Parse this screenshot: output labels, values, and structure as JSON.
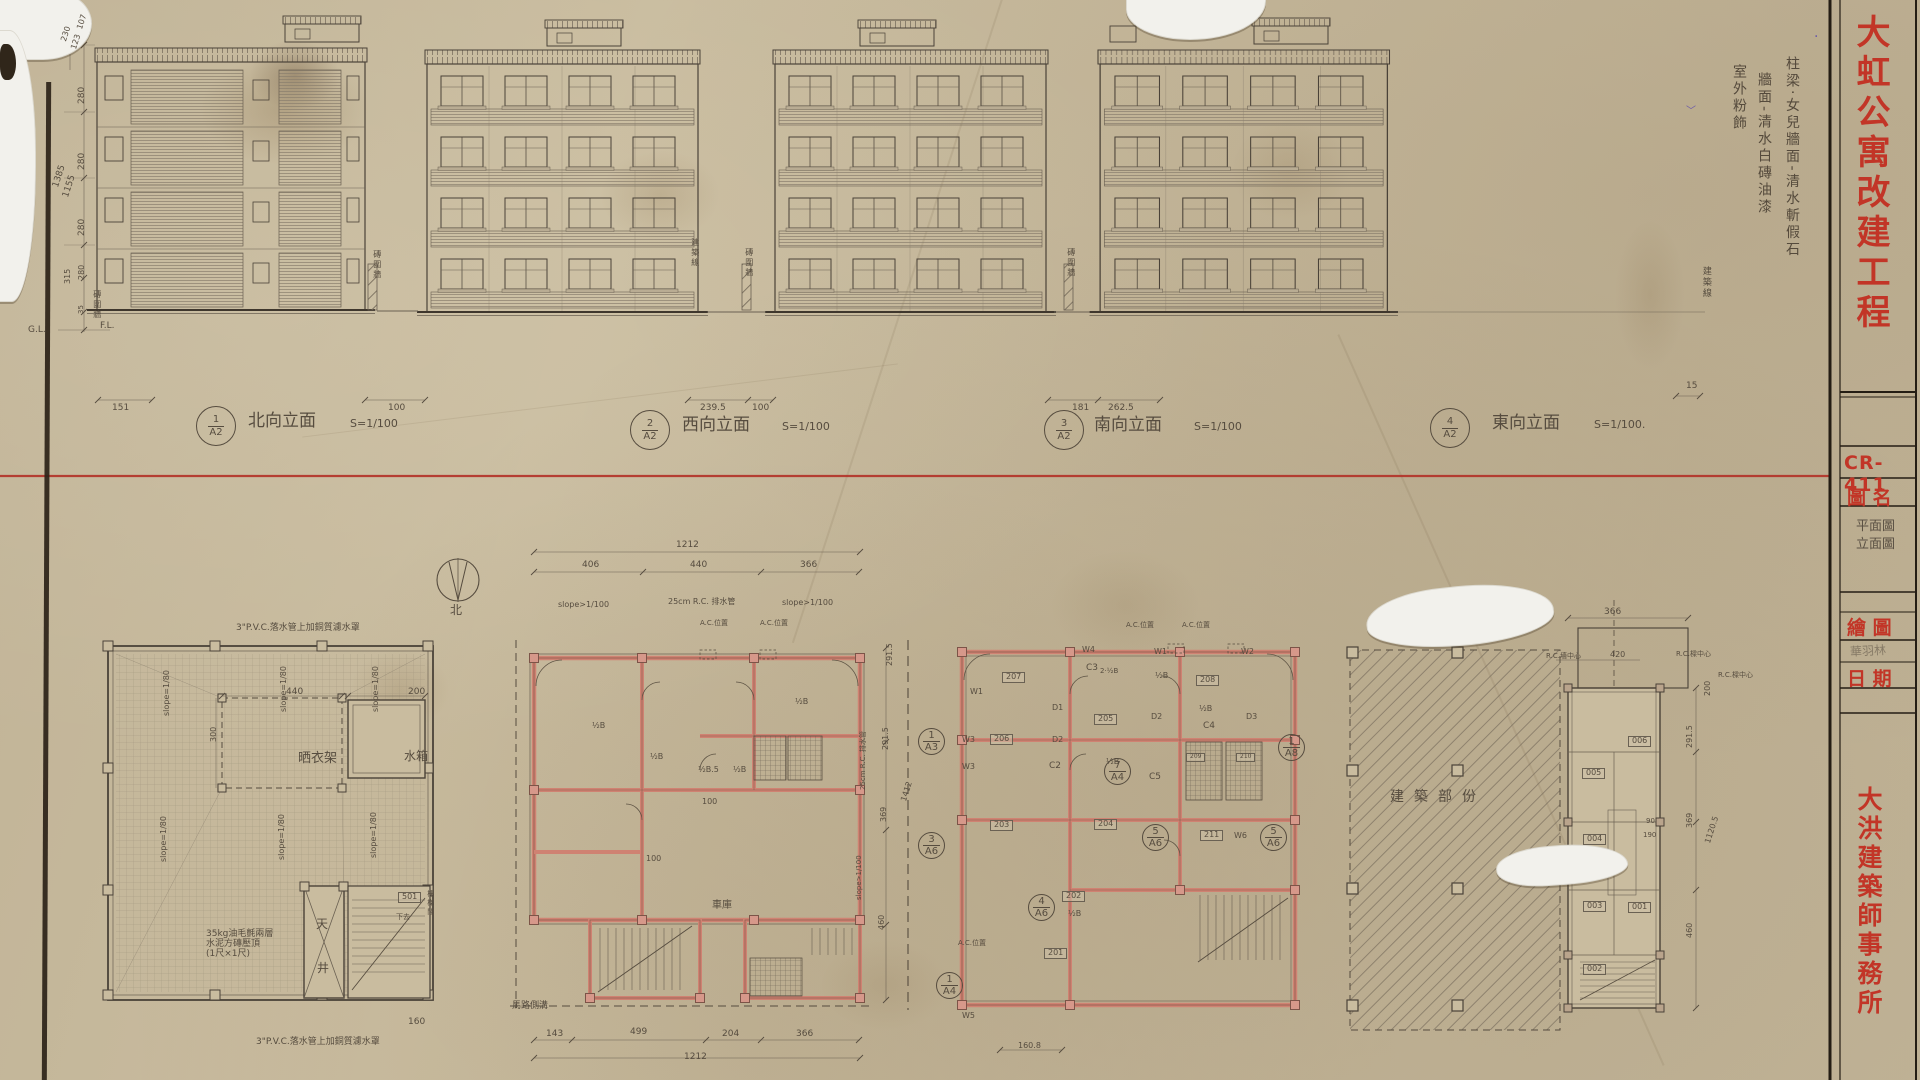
{
  "palette": {
    "pencil": "#564c3f",
    "dark": "#4a4238",
    "red": "#bf342a",
    "pink": "#cf8272",
    "paper": "#c9bc9f",
    "purple": "#6a5aa8"
  },
  "title_block": {
    "project_title": "大虹公寓改建工程",
    "drawing_no": "CR-411",
    "drawing_name_label": "圖 名",
    "drawing_name_line1": "平面圖",
    "drawing_name_line2": "立面圖",
    "drawn_by_label": "繪 圖",
    "drawn_by": "華羽林",
    "date_label": "日 期",
    "firm": "大洪建築師事務所"
  },
  "finish_notes": [
    "柱梁·女兒牆面-清水斬假石",
    "牆面-清水白磚油漆",
    "室外粉飾"
  ],
  "elevation_labels": [
    {
      "num": "1",
      "sheet": "A2",
      "name": "北向立面",
      "scale": "S=1/100"
    },
    {
      "num": "2",
      "sheet": "A2",
      "name": "西向立面",
      "scale": "S=1/100"
    },
    {
      "num": "3",
      "sheet": "A2",
      "name": "南向立面",
      "scale": "S=1/100"
    },
    {
      "num": "4",
      "sheet": "A2",
      "name": "東向立面",
      "scale": "S=1/100."
    }
  ],
  "annotations": [
    {
      "t": "107",
      "x": 76,
      "y": 28,
      "r": -72,
      "s": 8
    },
    {
      "t": "123",
      "x": 70,
      "y": 48,
      "r": -72,
      "s": 8
    },
    {
      "t": "230",
      "x": 60,
      "y": 40,
      "r": -72,
      "s": 8
    },
    {
      "t": "280",
      "x": 78,
      "y": 104,
      "r": -90,
      "s": 9
    },
    {
      "t": "280",
      "x": 78,
      "y": 170,
      "r": -90,
      "s": 9
    },
    {
      "t": "280",
      "x": 78,
      "y": 236,
      "r": -90,
      "s": 9
    },
    {
      "t": "1385",
      "x": 52,
      "y": 186,
      "r": -72,
      "s": 9
    },
    {
      "t": "1155",
      "x": 62,
      "y": 196,
      "r": -72,
      "s": 9
    },
    {
      "t": "315",
      "x": 64,
      "y": 284,
      "r": -90,
      "s": 8
    },
    {
      "t": "280",
      "x": 78,
      "y": 280,
      "r": -90,
      "s": 8
    },
    {
      "t": "35",
      "x": 78,
      "y": 314,
      "r": -90,
      "s": 7
    },
    {
      "t": "G.L.",
      "x": 28,
      "y": 326,
      "s": 9
    },
    {
      "t": "F.L.",
      "x": 100,
      "y": 322,
      "s": 9
    },
    {
      "t": "磚圍牆",
      "x": 92,
      "y": 290,
      "s": 8,
      "cls": "vert"
    },
    {
      "t": "151",
      "x": 112,
      "y": 404,
      "s": 9
    },
    {
      "t": "100",
      "x": 388,
      "y": 404,
      "s": 9
    },
    {
      "t": "239.5",
      "x": 700,
      "y": 404,
      "s": 9
    },
    {
      "t": "100",
      "x": 752,
      "y": 404,
      "s": 9
    },
    {
      "t": "181",
      "x": 1072,
      "y": 404,
      "s": 9
    },
    {
      "t": "262.5",
      "x": 1108,
      "y": 404,
      "s": 9
    },
    {
      "t": "15",
      "x": 1686,
      "y": 382,
      "s": 9
    },
    {
      "t": "磚圍牆",
      "x": 372,
      "y": 250,
      "s": 8,
      "cls": "vert"
    },
    {
      "t": "磚圍牆",
      "x": 744,
      "y": 248,
      "s": 8,
      "cls": "vert"
    },
    {
      "t": "磚圍牆",
      "x": 1066,
      "y": 248,
      "s": 8,
      "cls": "vert"
    },
    {
      "t": "建築線",
      "x": 690,
      "y": 238,
      "s": 8,
      "cls": "vert"
    },
    {
      "t": "建築線",
      "x": 1700,
      "y": 266,
      "s": 9,
      "cls": "vert"
    },
    {
      "t": "1|A2",
      "x": 196,
      "y": 406,
      "cls": "frac"
    },
    {
      "t": "北向立面",
      "x": 248,
      "y": 412,
      "s": 17
    },
    {
      "t": "S=1/100",
      "x": 350,
      "y": 418,
      "s": 11
    },
    {
      "t": "2|A2",
      "x": 630,
      "y": 410,
      "cls": "frac"
    },
    {
      "t": "西向立面",
      "x": 682,
      "y": 416,
      "s": 17
    },
    {
      "t": "S=1/100",
      "x": 782,
      "y": 421,
      "s": 11
    },
    {
      "t": "3|A2",
      "x": 1044,
      "y": 410,
      "cls": "frac"
    },
    {
      "t": "南向立面",
      "x": 1094,
      "y": 416,
      "s": 17
    },
    {
      "t": "S=1/100",
      "x": 1194,
      "y": 421,
      "s": 11
    },
    {
      "t": "4|A2",
      "x": 1430,
      "y": 408,
      "cls": "frac"
    },
    {
      "t": "東向立面",
      "x": 1492,
      "y": 414,
      "s": 17
    },
    {
      "t": "S=1/100.",
      "x": 1594,
      "y": 419,
      "s": 11
    },
    {
      "t": "北",
      "x": 450,
      "y": 604,
      "s": 12
    },
    {
      "t": "3\"P.V.C.落水管上加銅質濾水罩",
      "x": 236,
      "y": 624,
      "s": 9
    },
    {
      "t": "3\"P.V.C.落水管上加銅質濾水罩",
      "x": 256,
      "y": 1038,
      "s": 9
    },
    {
      "t": "slope=1/80",
      "x": 163,
      "y": 716,
      "r": -90,
      "s": 8
    },
    {
      "t": "slope=1/80",
      "x": 280,
      "y": 712,
      "r": -90,
      "s": 8
    },
    {
      "t": "slope=1/80",
      "x": 372,
      "y": 712,
      "r": -90,
      "s": 8
    },
    {
      "t": "slope=1/80",
      "x": 160,
      "y": 862,
      "r": -90,
      "s": 8
    },
    {
      "t": "slope=1/80",
      "x": 278,
      "y": 860,
      "r": -90,
      "s": 8
    },
    {
      "t": "slope=1/80",
      "x": 370,
      "y": 858,
      "r": -90,
      "s": 8
    },
    {
      "t": "晒衣架",
      "x": 298,
      "y": 752,
      "s": 13
    },
    {
      "t": "水箱",
      "x": 404,
      "y": 750,
      "s": 12
    },
    {
      "t": "440",
      "x": 286,
      "y": 688,
      "s": 9
    },
    {
      "t": "200",
      "x": 408,
      "y": 688,
      "s": 9
    },
    {
      "t": "300",
      "x": 210,
      "y": 742,
      "r": -90,
      "s": 8
    },
    {
      "t": "35kg油毛氈兩層\n水泥方磚壓頂\n(1尺×1尺)",
      "x": 206,
      "y": 930,
      "s": 9,
      "cls": "ml"
    },
    {
      "t": "天",
      "x": 316,
      "y": 918,
      "s": 12
    },
    {
      "t": "井",
      "x": 317,
      "y": 962,
      "s": 12
    },
    {
      "t": "501",
      "x": 398,
      "y": 892,
      "s": 8,
      "cls": "box"
    },
    {
      "t": "樓梯間",
      "x": 426,
      "y": 890,
      "s": 7,
      "cls": "vert"
    },
    {
      "t": "下去",
      "x": 396,
      "y": 914,
      "s": 7
    },
    {
      "t": "160",
      "x": 408,
      "y": 1018,
      "s": 9
    },
    {
      "t": "1212",
      "x": 676,
      "y": 541,
      "s": 9
    },
    {
      "t": "406",
      "x": 582,
      "y": 561,
      "s": 9
    },
    {
      "t": "440",
      "x": 690,
      "y": 561,
      "s": 9
    },
    {
      "t": "366",
      "x": 800,
      "y": 561,
      "s": 9
    },
    {
      "t": "slope>1/100",
      "x": 558,
      "y": 601,
      "s": 8
    },
    {
      "t": "25cm R.C. 排水管",
      "x": 668,
      "y": 598,
      "s": 8
    },
    {
      "t": "slope>1/100",
      "x": 782,
      "y": 599,
      "s": 8
    },
    {
      "t": "A.C.位置",
      "x": 700,
      "y": 620,
      "s": 7
    },
    {
      "t": "A.C.位置",
      "x": 760,
      "y": 620,
      "s": 7
    },
    {
      "t": "½B",
      "x": 592,
      "y": 722,
      "s": 8
    },
    {
      "t": "½B",
      "x": 650,
      "y": 753,
      "s": 8
    },
    {
      "t": "½B",
      "x": 795,
      "y": 698,
      "s": 8
    },
    {
      "t": "½B.5",
      "x": 698,
      "y": 766,
      "s": 8
    },
    {
      "t": "½B",
      "x": 733,
      "y": 766,
      "s": 8
    },
    {
      "t": "100",
      "x": 702,
      "y": 798,
      "s": 8
    },
    {
      "t": "100",
      "x": 646,
      "y": 855,
      "s": 8
    },
    {
      "t": "車庫",
      "x": 712,
      "y": 900,
      "s": 10
    },
    {
      "t": "291.5",
      "x": 886,
      "y": 666,
      "r": -90,
      "s": 8
    },
    {
      "t": "291.5",
      "x": 882,
      "y": 750,
      "r": -90,
      "s": 8
    },
    {
      "t": "369",
      "x": 880,
      "y": 822,
      "r": -90,
      "s": 8
    },
    {
      "t": "1412",
      "x": 900,
      "y": 800,
      "r": -72,
      "s": 8
    },
    {
      "t": "25cm R.C. 排水管",
      "x": 860,
      "y": 790,
      "r": -90,
      "s": 7
    },
    {
      "t": "slope>1/100",
      "x": 856,
      "y": 900,
      "r": -90,
      "s": 7
    },
    {
      "t": "460",
      "x": 878,
      "y": 930,
      "r": -90,
      "s": 8
    },
    {
      "t": "143",
      "x": 546,
      "y": 1030,
      "s": 9
    },
    {
      "t": "499",
      "x": 630,
      "y": 1028,
      "s": 9
    },
    {
      "t": "204",
      "x": 722,
      "y": 1030,
      "s": 9
    },
    {
      "t": "366",
      "x": 796,
      "y": 1030,
      "s": 9
    },
    {
      "t": "1212",
      "x": 684,
      "y": 1053,
      "s": 9
    },
    {
      "t": "馬路側溝",
      "x": 512,
      "y": 1002,
      "s": 9
    },
    {
      "t": "207",
      "x": 1002,
      "y": 672,
      "s": 8,
      "cls": "box"
    },
    {
      "t": "206",
      "x": 990,
      "y": 734,
      "s": 8,
      "cls": "box"
    },
    {
      "t": "205",
      "x": 1094,
      "y": 714,
      "s": 8,
      "cls": "box"
    },
    {
      "t": "208",
      "x": 1196,
      "y": 675,
      "s": 8,
      "cls": "box"
    },
    {
      "t": "204",
      "x": 1094,
      "y": 819,
      "s": 8,
      "cls": "box"
    },
    {
      "t": "211",
      "x": 1200,
      "y": 830,
      "s": 8,
      "cls": "box"
    },
    {
      "t": "203",
      "x": 990,
      "y": 820,
      "s": 8,
      "cls": "box"
    },
    {
      "t": "202",
      "x": 1062,
      "y": 891,
      "s": 8,
      "cls": "box"
    },
    {
      "t": "201",
      "x": 1044,
      "y": 948,
      "s": 8,
      "cls": "box"
    },
    {
      "t": "209",
      "x": 1186,
      "y": 753,
      "s": 6,
      "cls": "box"
    },
    {
      "t": "210",
      "x": 1236,
      "y": 753,
      "s": 6,
      "cls": "box"
    },
    {
      "t": "W1",
      "x": 970,
      "y": 688,
      "s": 8
    },
    {
      "t": "W3",
      "x": 962,
      "y": 736,
      "s": 8
    },
    {
      "t": "W3",
      "x": 962,
      "y": 763,
      "s": 8
    },
    {
      "t": "W4",
      "x": 1082,
      "y": 646,
      "s": 8
    },
    {
      "t": "W1",
      "x": 1154,
      "y": 648,
      "s": 8
    },
    {
      "t": "W2",
      "x": 1241,
      "y": 648,
      "s": 8
    },
    {
      "t": "W6",
      "x": 1234,
      "y": 832,
      "s": 8
    },
    {
      "t": "W5",
      "x": 962,
      "y": 1012,
      "s": 8
    },
    {
      "t": "D1",
      "x": 1052,
      "y": 704,
      "s": 8
    },
    {
      "t": "D2",
      "x": 1052,
      "y": 736,
      "s": 8
    },
    {
      "t": "D2",
      "x": 1151,
      "y": 713,
      "s": 8
    },
    {
      "t": "D3",
      "x": 1246,
      "y": 713,
      "s": 8
    },
    {
      "t": "C3",
      "x": 1086,
      "y": 664,
      "s": 9
    },
    {
      "t": "C2",
      "x": 1049,
      "y": 762,
      "s": 9
    },
    {
      "t": "C4",
      "x": 1203,
      "y": 722,
      "s": 9
    },
    {
      "t": "C5",
      "x": 1149,
      "y": 773,
      "s": 9
    },
    {
      "t": "2·½B",
      "x": 1100,
      "y": 668,
      "s": 7
    },
    {
      "t": "½B",
      "x": 1155,
      "y": 672,
      "s": 8
    },
    {
      "t": "½B",
      "x": 1199,
      "y": 705,
      "s": 8
    },
    {
      "t": "½B",
      "x": 1106,
      "y": 758,
      "s": 8
    },
    {
      "t": "½B",
      "x": 1068,
      "y": 910,
      "s": 8
    },
    {
      "t": "A.C.位置",
      "x": 1126,
      "y": 622,
      "s": 7
    },
    {
      "t": "A.C.位置",
      "x": 1182,
      "y": 622,
      "s": 7
    },
    {
      "t": "A.C.位置",
      "x": 958,
      "y": 940,
      "s": 7
    },
    {
      "t": "1|A3",
      "x": 918,
      "y": 728,
      "cls": "frac2"
    },
    {
      "t": "7|A4",
      "x": 1104,
      "y": 758,
      "cls": "frac2"
    },
    {
      "t": "1|A8",
      "x": 1278,
      "y": 734,
      "cls": "frac2"
    },
    {
      "t": "5|A6",
      "x": 1142,
      "y": 824,
      "cls": "frac2"
    },
    {
      "t": "5|A6",
      "x": 1260,
      "y": 824,
      "cls": "frac2"
    },
    {
      "t": "3|A6",
      "x": 918,
      "y": 832,
      "cls": "frac2"
    },
    {
      "t": "4|A6",
      "x": 1028,
      "y": 894,
      "cls": "frac2"
    },
    {
      "t": "1|A4",
      "x": 936,
      "y": 972,
      "cls": "frac2"
    },
    {
      "t": "160.8",
      "x": 1018,
      "y": 1042,
      "s": 8
    },
    {
      "t": "建築部份",
      "x": 1390,
      "y": 790,
      "s": 14,
      "cls": "sp"
    },
    {
      "t": "366",
      "x": 1604,
      "y": 608,
      "s": 9
    },
    {
      "t": "R.C.墻中心",
      "x": 1546,
      "y": 653,
      "s": 7
    },
    {
      "t": "420",
      "x": 1610,
      "y": 651,
      "s": 8
    },
    {
      "t": "R.C.樑中心",
      "x": 1676,
      "y": 651,
      "s": 7
    },
    {
      "t": "R.C.樑中心",
      "x": 1718,
      "y": 672,
      "s": 7
    },
    {
      "t": "200",
      "x": 1704,
      "y": 696,
      "r": -90,
      "s": 8
    },
    {
      "t": "291.5",
      "x": 1686,
      "y": 748,
      "r": -90,
      "s": 8
    },
    {
      "t": "369",
      "x": 1686,
      "y": 828,
      "r": -90,
      "s": 8
    },
    {
      "t": "1120.5",
      "x": 1704,
      "y": 842,
      "r": -72,
      "s": 8
    },
    {
      "t": "460",
      "x": 1686,
      "y": 938,
      "r": -90,
      "s": 8
    },
    {
      "t": "90",
      "x": 1646,
      "y": 818,
      "s": 7
    },
    {
      "t": "190",
      "x": 1643,
      "y": 832,
      "s": 7
    },
    {
      "t": "006",
      "x": 1628,
      "y": 736,
      "s": 8,
      "cls": "box"
    },
    {
      "t": "005",
      "x": 1582,
      "y": 768,
      "s": 8,
      "cls": "box"
    },
    {
      "t": "004",
      "x": 1583,
      "y": 834,
      "s": 8,
      "cls": "box"
    },
    {
      "t": "003",
      "x": 1583,
      "y": 901,
      "s": 8,
      "cls": "box"
    },
    {
      "t": "001",
      "x": 1628,
      "y": 902,
      "s": 8,
      "cls": "box"
    },
    {
      "t": "002",
      "x": 1583,
      "y": 964,
      "s": 8,
      "cls": "box"
    },
    {
      "t": "﹀",
      "x": 1686,
      "y": 106,
      "s": 10,
      "c": "purple"
    },
    {
      "t": "·",
      "x": 1814,
      "y": 30,
      "s": 14,
      "c": "purple"
    }
  ]
}
